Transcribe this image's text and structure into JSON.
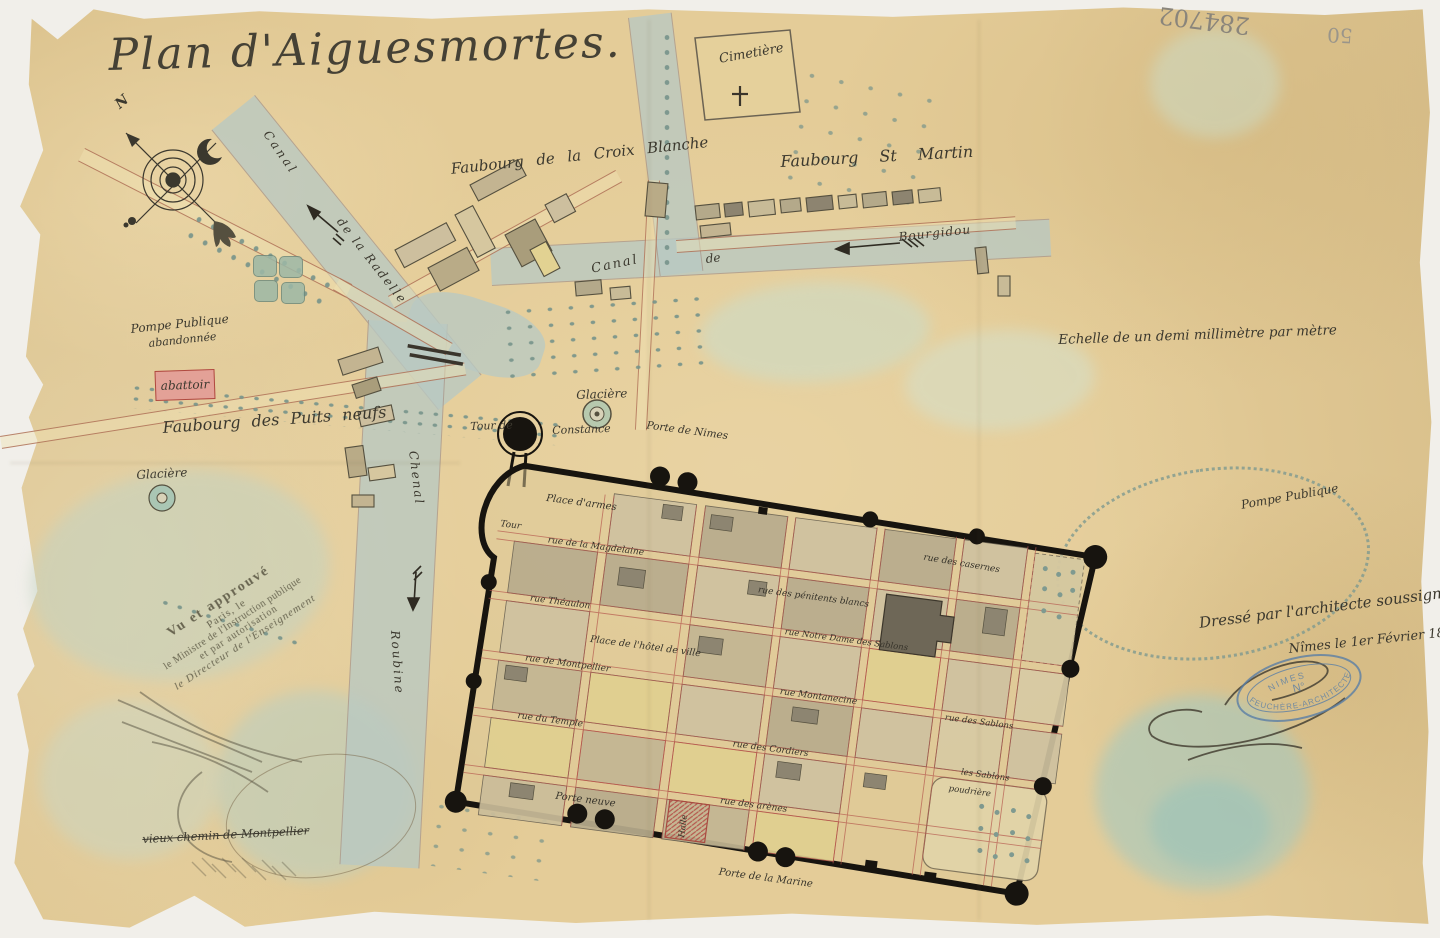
{
  "page": {
    "title": "Plan d'Aiguesmortes."
  },
  "compass": {
    "north": "N"
  },
  "waterways": {
    "canal_radelle_1": "Canal",
    "canal_radelle_2": "de la Radelle",
    "canal_bourgidou_1": "Canal",
    "canal_bourgidou_2": "de",
    "canal_bourgidou_3": "Bourgidou",
    "chenal": "Chenal",
    "roubine": "Roubine"
  },
  "districts": {
    "faubourg_croix_blanche": "Faubourg de la Croix Blanche",
    "faubourg_st_martin": "Faubourg St Martin",
    "faubourg_puits_neufs": "Faubourg des Puits neufs"
  },
  "landmarks": {
    "cimetiere": "Cimetière",
    "pompe_abandonnee_1": "Pompe Publique",
    "pompe_abandonnee_2": "abandonnée",
    "abattoir": "abattoir",
    "glaciere_ouest": "Glacière",
    "glaciere_nord": "Glacière",
    "tour_constance_1": "Tour de",
    "tour_constance_2": "Constance",
    "pompe_publique": "Pompe Publique",
    "vieux_chemin": "vieux chemin de Montpellier"
  },
  "city": {
    "place_armes": "Place d'armes",
    "tour": "Tour",
    "porte_nimes": "Porte de Nimes",
    "porte_neuve": "Porte neuve",
    "porte_marine": "Porte de la Marine",
    "halle": "Halle",
    "poudriere": "poudrière",
    "place_hotel_ville": "Place de l'hôtel de ville",
    "rue_casernes": "rue des casernes",
    "rue_magdelaine": "rue de la Magdelaine",
    "rue_penitents": "rue des pénitents blancs",
    "rue_theaulon": "rue Théaulon",
    "rue_nd_sablons": "rue Notre Dame des Sablons",
    "rue_montpellier": "rue de Montpellier",
    "rue_montanecine": "rue Montanecine",
    "rue_temple": "rue du Temple",
    "rue_cordiers": "rue des Cordiers",
    "rue_arenes": "rue des arènes",
    "rue_sablons": "rue des Sablons",
    "les_sablons": "les Sablons"
  },
  "scale_note": "Echelle de un demi millimètre par mètre",
  "certification": {
    "line1": "Dressé par l'architecte soussigné",
    "line2": "Nîmes le 1er Février 1881",
    "stamp_top": "NIMES",
    "stamp_no": "N°",
    "stamp_bottom": "FEUCHÈRE-ARCHITECTE"
  },
  "approval_stamp": {
    "l1": "Vu et approuvé",
    "l2": "Paris, le",
    "l3": "le Ministre de l'Instruction publique",
    "l4": "et par autorisation",
    "l5": "le Directeur de l'Enseignement"
  },
  "archive_marks": {
    "pencil_number": "284702",
    "pencil_number_2": "50"
  },
  "colors": {
    "paper": "#e4cc98",
    "water": "#b9c9c3",
    "wash_green": "#c3d3c2",
    "ink": "#3b382e",
    "wall": "#17140f",
    "street_red": "#b5574d",
    "stamp_blue": "#5b7fa6",
    "abattoir_red": "#e3a197"
  }
}
